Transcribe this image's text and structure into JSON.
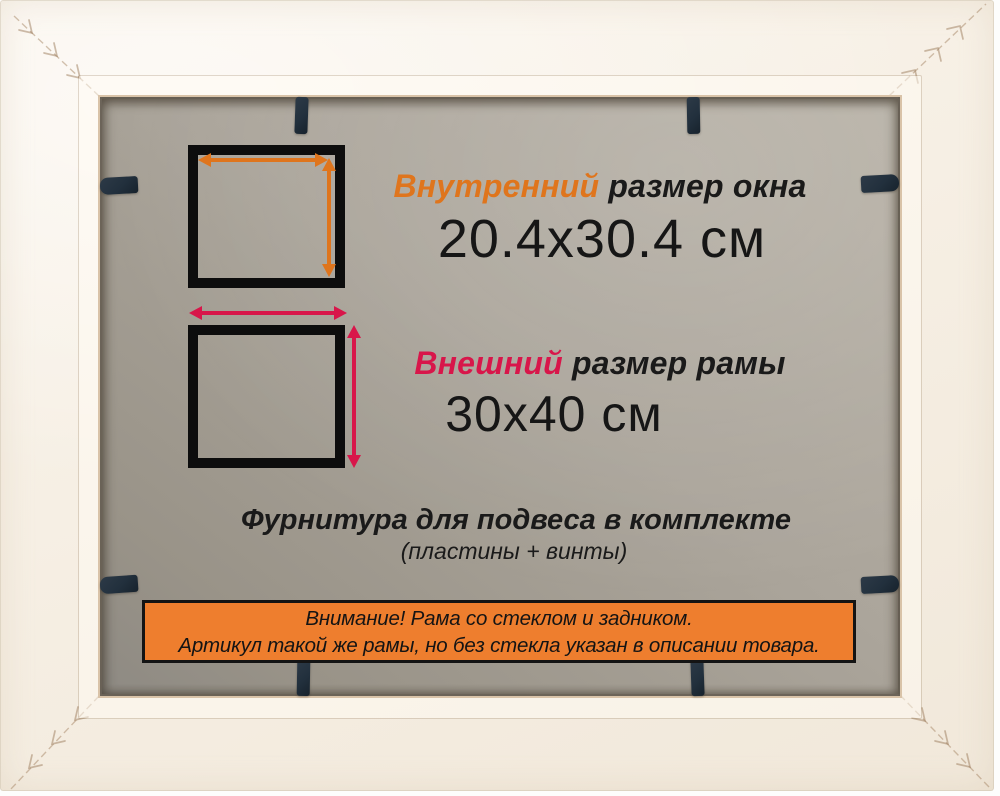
{
  "inner_window": {
    "label_accent": "Внутренний",
    "label_rest": "размер окна",
    "value": "20.4x30.4 см"
  },
  "outer_frame": {
    "label_accent": "Внешний",
    "label_rest": "размер рамы",
    "value": "30x40 см"
  },
  "hardware": {
    "line1": "Фурнитура для подвеса в комплекте",
    "line2": "(пластины + винты)"
  },
  "notice": {
    "line1": "Внимание! Рама со стеклом и задником.",
    "line2": "Артикул такой же рамы, но без стекла указан в описании товара."
  },
  "colors": {
    "frame_cream": "#f6efe4",
    "backing_gray": "#aba59b",
    "clip_navy": "#22303d",
    "diagram_black": "#0d0d0d",
    "accent_orange": "#df751d",
    "accent_red": "#d8164a",
    "banner_orange": "#ee7e2e"
  },
  "icons": {
    "width_arrow": "double-headed-horizontal-arrow",
    "height_arrow": "double-headed-vertical-arrow",
    "flex_clip": "dark-navy-backing-clip",
    "miter_seam": "diagonal-corner-seam-with-stitches"
  }
}
